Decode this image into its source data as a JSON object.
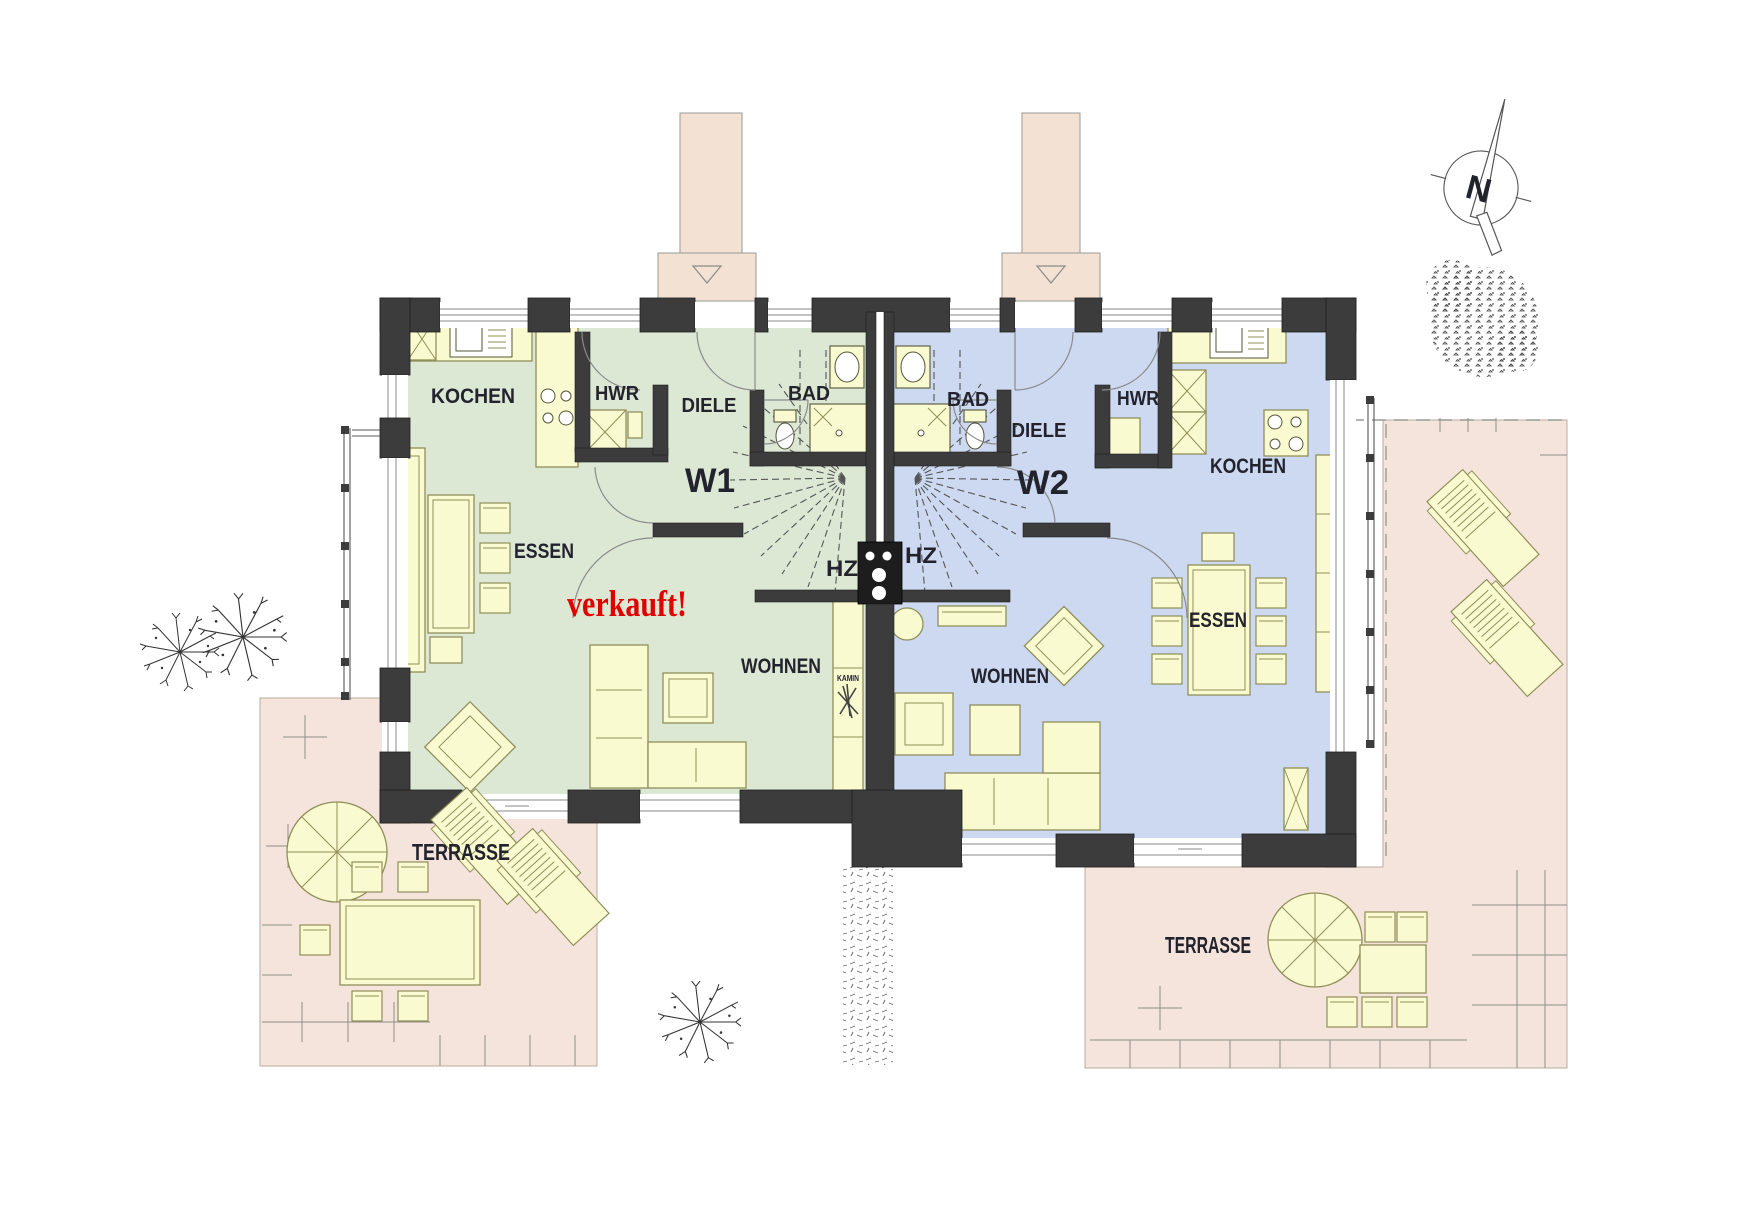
{
  "plan": {
    "units": {
      "w1": {
        "id": "W1",
        "status": "verkauft!",
        "rooms": {
          "kochen": "KOCHEN",
          "hwr": "HWR",
          "diele": "DIELE",
          "bad": "BAD",
          "hz": "HZ",
          "essen": "ESSEN",
          "wohnen": "WOHNEN",
          "kamin": "KAMIN"
        }
      },
      "w2": {
        "id": "W2",
        "rooms": {
          "kochen": "KOCHEN",
          "hwr": "HWR",
          "diele": "DIELE",
          "bad": "BAD",
          "hz": "HZ",
          "essen": "ESSEN",
          "wohnen": "WOHNEN"
        }
      }
    },
    "site": {
      "terrace_left": "TERRASSE",
      "terrace_right": "TERRASSE",
      "north": "N"
    },
    "colors": {
      "w1_floor": "#dce8d4",
      "w2_floor": "#ccd9f1",
      "furniture": "#fafad0",
      "terrace": "#f5e4db",
      "walkway": "#f3e2d4",
      "wall": "#3c3c3c",
      "sold_text": "#e00000",
      "label_text": "#23232e"
    }
  }
}
